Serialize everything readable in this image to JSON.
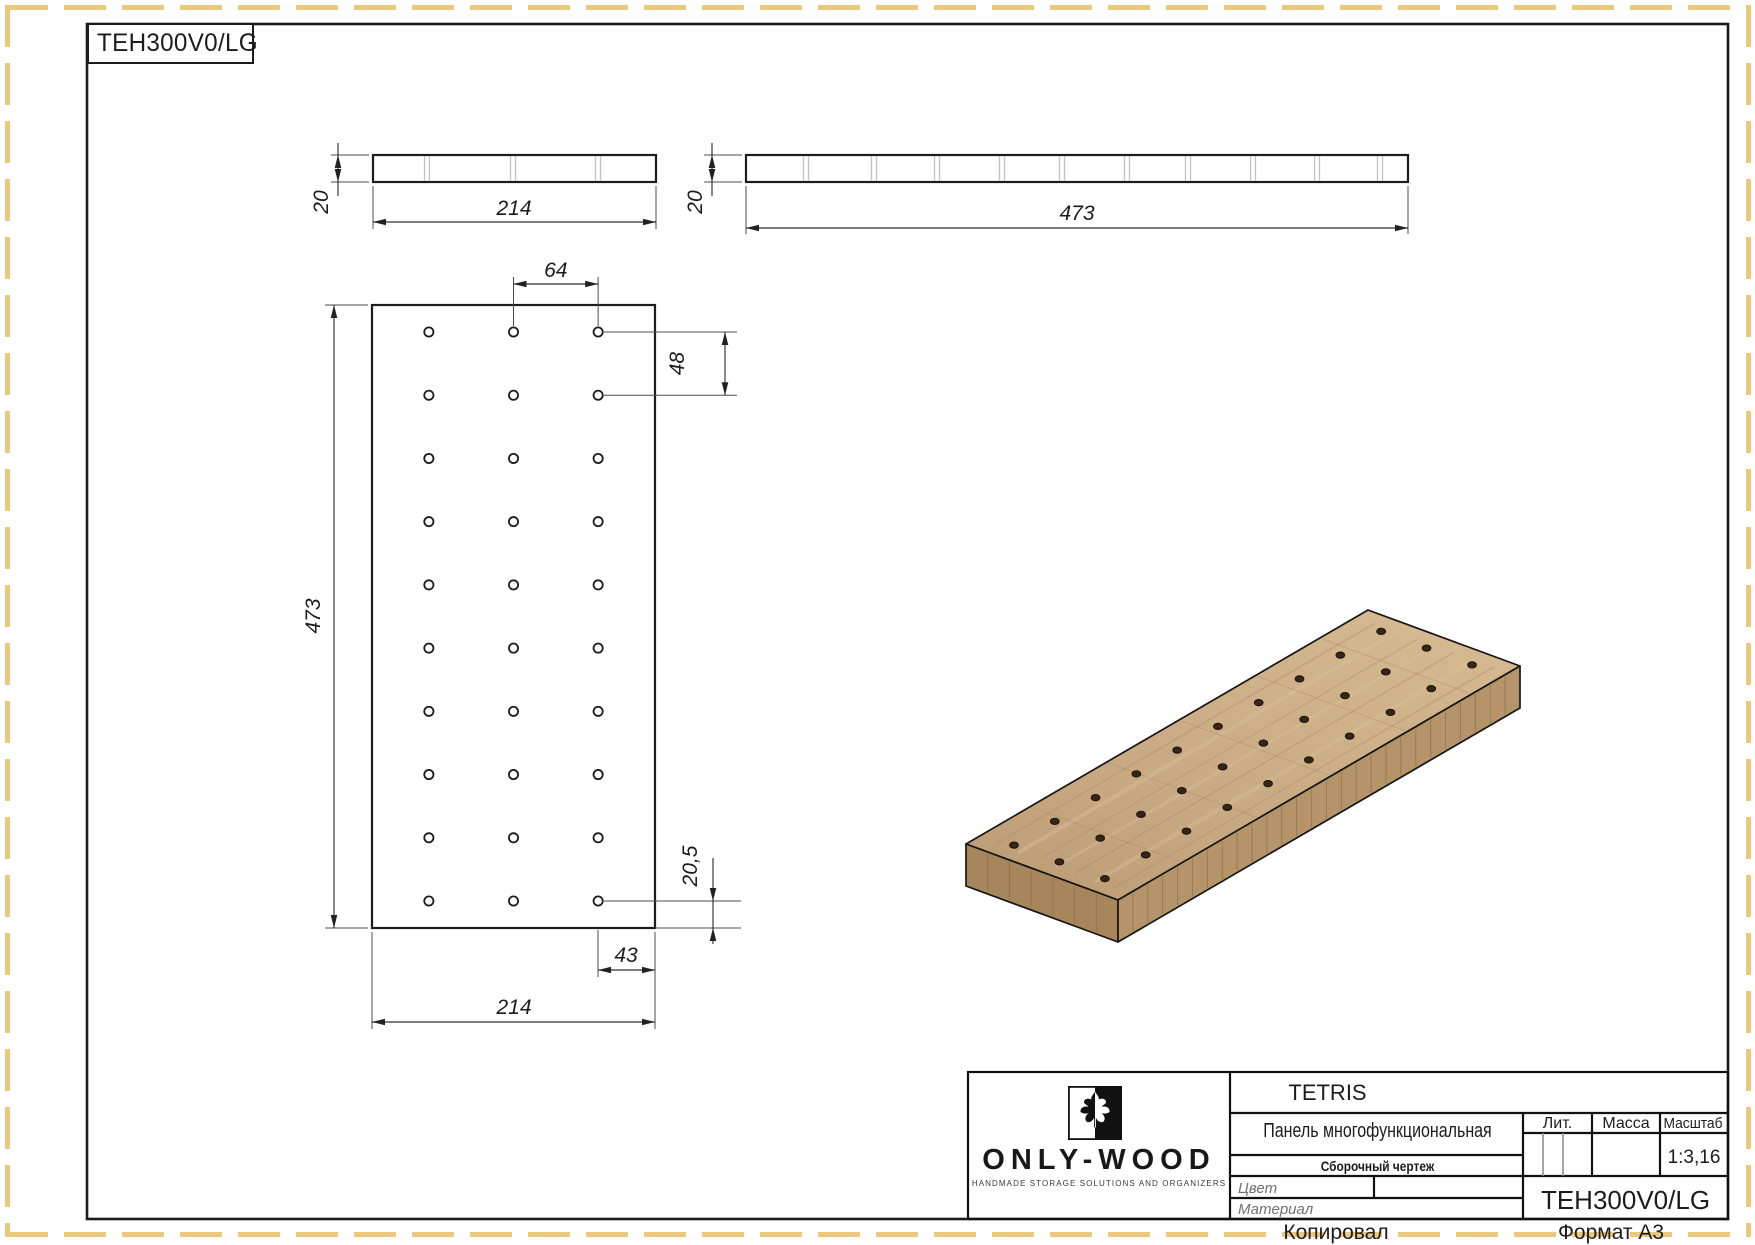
{
  "stamp_label": "TEH300V0/LG",
  "dims": {
    "side_left_thickness": "20",
    "side_left_width": "214",
    "side_right_thickness": "20",
    "side_right_length": "473",
    "front_col_spacing": "64",
    "front_row_spacing": "48",
    "front_length": "473",
    "front_bottom_margin": "20,5",
    "front_side_margin": "43",
    "front_width": "214"
  },
  "holes": {
    "rows": 10,
    "cols": 3,
    "row_margin_mm": 20.5,
    "col_margin_mm": 43,
    "row_pitch_mm": 48,
    "col_pitch_mm": 64,
    "panel_length_mm": 473,
    "panel_width_mm": 214,
    "panel_thickness_mm": 20
  },
  "title_block": {
    "brand": "ONLY-WOOD",
    "tagline": "HANDMADE STORAGE SOLUTIONS AND ORGANIZERS",
    "series": "TETRIS",
    "part_name": "Панель многофункциональная",
    "doc_type": "Сборочный чертеж",
    "lit_label": "Лит.",
    "mass_label": "Масса",
    "scale_label": "Масштаб",
    "scale_value": "1:3,16",
    "color_label": "Цвет",
    "material_label": "Материал",
    "part_code": "TEH300V0/LG"
  },
  "footer": {
    "copied": "Копировал",
    "format": "Формат А3"
  },
  "colors": {
    "dash_border": "#eac87c",
    "wood_top_light": "#d2b58e",
    "wood_top_dark": "#bfa077",
    "wood_side_right": "#b5946a",
    "wood_side_left": "#a8865c",
    "line": "#1c1c1c"
  }
}
